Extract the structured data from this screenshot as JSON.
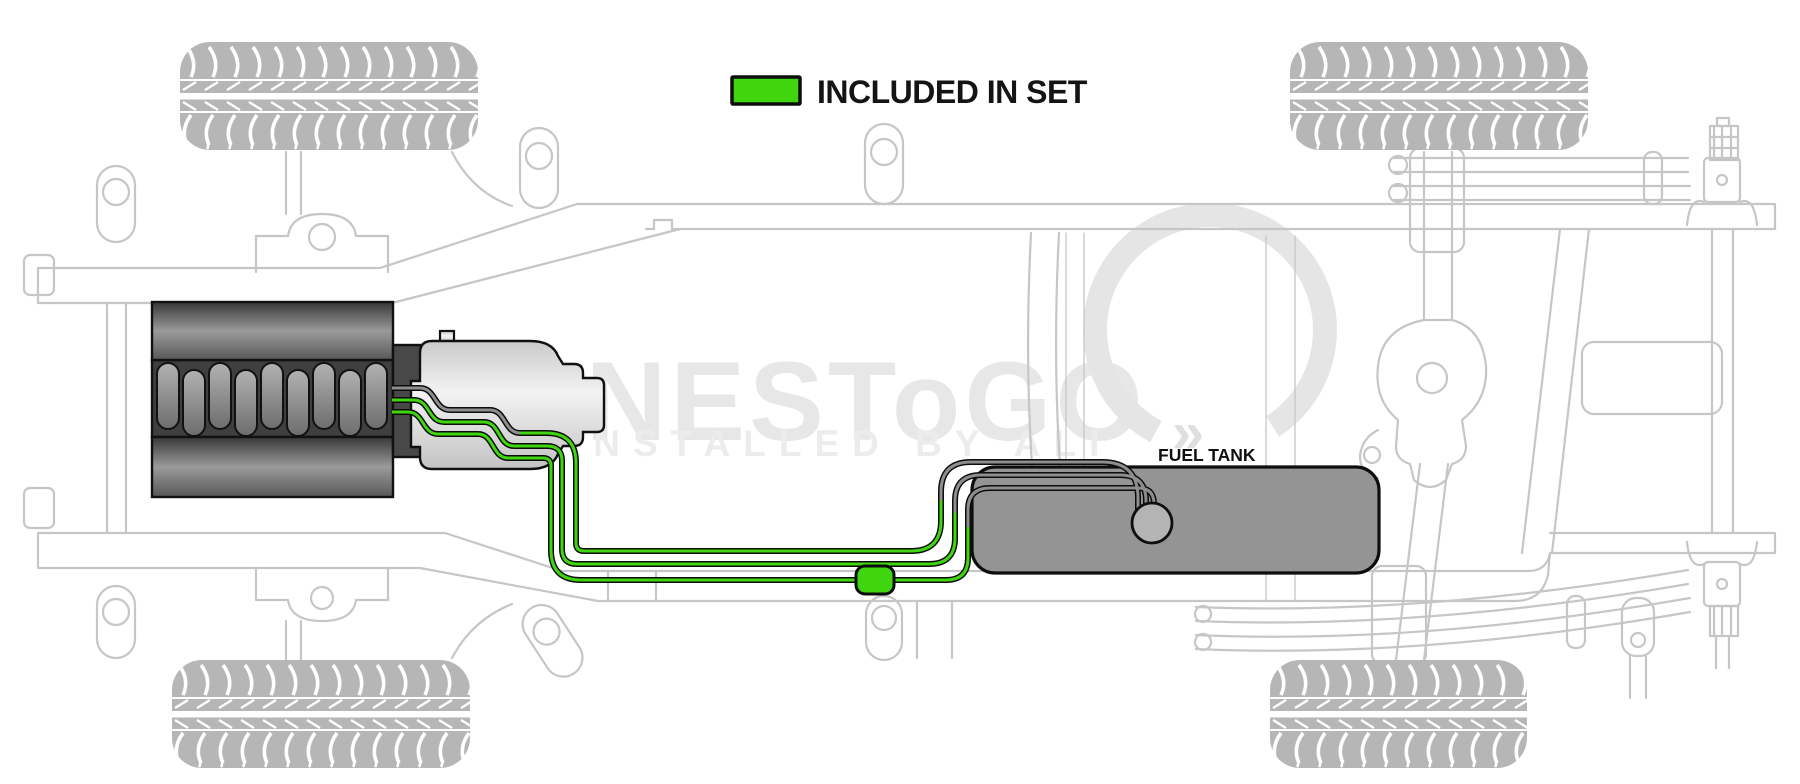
{
  "legend": {
    "label": "INCLUDED IN SET",
    "swatch_color": "#3fd60f"
  },
  "fuel_tank_label": "FUEL TANK",
  "watermark": {
    "brand": "LINESToGO",
    "tagline": "INSTALLED BY ALI",
    "symbol": "»"
  },
  "colors": {
    "included_line_green": "#3fd60f",
    "other_line_gray": "#8e8e8e",
    "line_casing": "#0c0c0c",
    "chassis_outline": "#c6c6c6",
    "tank_fill": "#949494",
    "background": "#ffffff"
  }
}
